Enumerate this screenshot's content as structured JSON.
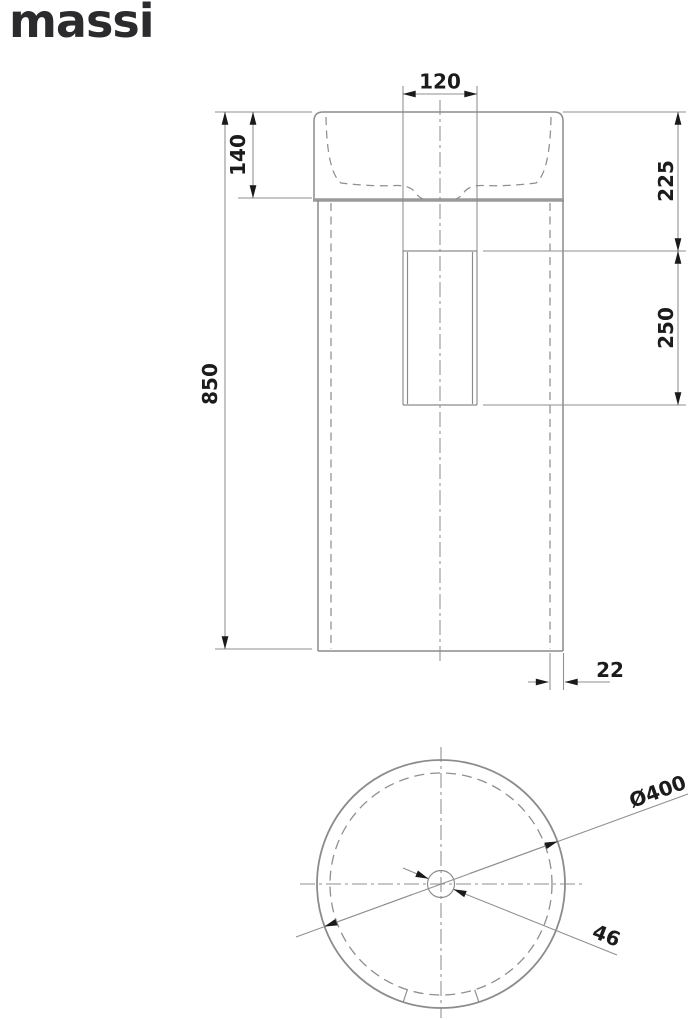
{
  "logo": {
    "text": "massi"
  },
  "front_view": {
    "width_top": "120",
    "basin_height": "140",
    "rim_to_opening": "225",
    "opening_height": "250",
    "total_height": "850",
    "wall_thickness": "22"
  },
  "top_view": {
    "outer_diameter": "Ø400",
    "drain_diameter": "46"
  },
  "colors": {
    "line": "#8c8c8c",
    "hidden_line": "#8f8f8f",
    "text": "#1b1b1b",
    "logo": "#2b2b2d",
    "background": "#ffffff"
  }
}
